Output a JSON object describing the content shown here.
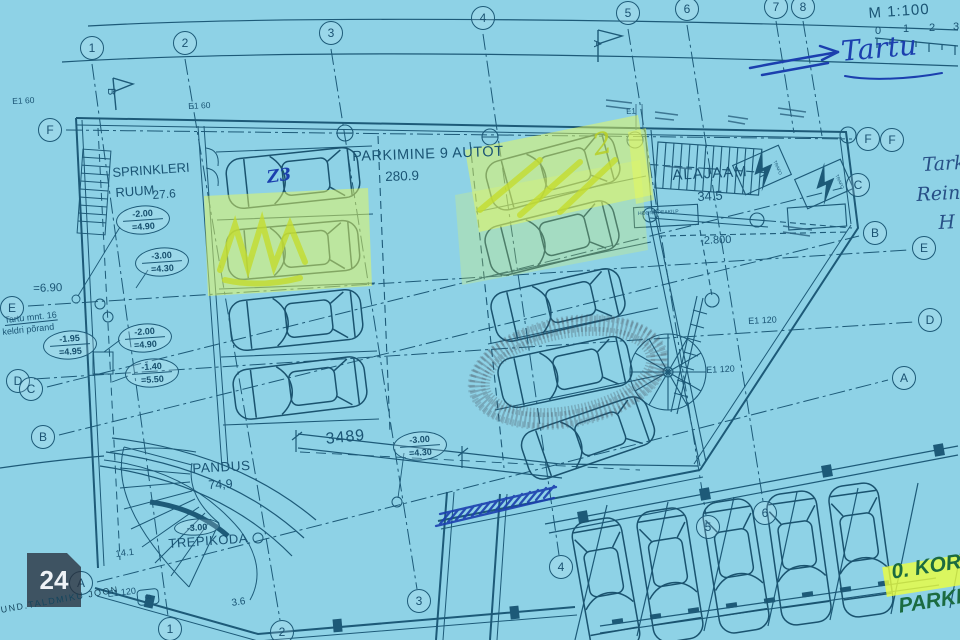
{
  "meta": {
    "scale": "M 1:100",
    "ticks": [
      "0",
      "1",
      "2",
      "3"
    ]
  },
  "pen": {
    "site": "Tartu",
    "margin1": "Tark",
    "margin2": "Reina",
    "margin3": "H",
    "car_mark": "Z3",
    "stall_mark": "2"
  },
  "rooms": {
    "sprinkler": {
      "l1": "SPRINKLERI",
      "l2": "RUUM",
      "area": "27.6"
    },
    "parking": {
      "title": "PARKIMINE 9 AUTOT",
      "area": "280.9"
    },
    "alajaam": {
      "title": "ALAJAAM",
      "area": "34.5",
      "level": "-2.800",
      "board": "HOONE PEAKILP",
      "trafo1": "TRAFO",
      "trafo2": "TRAFO"
    },
    "pandus": {
      "title": "PANDUS",
      "area": "74,9"
    },
    "trepikoda": {
      "title": "TREPIKODA",
      "area": "14.1"
    }
  },
  "tags": [
    {
      "t": "-2.00",
      "b": "=4.90"
    },
    {
      "t": "-3.00",
      "b": "=4.30"
    },
    {
      "t": "-1.95",
      "b": "=4.95"
    },
    {
      "t": "-2.00",
      "b": "=4.90"
    },
    {
      "t": "-1.40",
      "b": "=5.50"
    },
    {
      "t": "-3.00",
      "b": "=4.30"
    },
    {
      "t": "-3.00"
    }
  ],
  "notes": {
    "approx": "=6.90",
    "street1": "Tartu mnt. 16",
    "street2": "keldri põrand",
    "e1a": "E1 60",
    "e1b": "E1 60",
    "e1c": "E1 120",
    "e1d": "E1 120",
    "e1e": "E1 120",
    "e1f": "E1",
    "dim1": "3489",
    "dim2": "3.6"
  },
  "grid": {
    "top": [
      "1",
      "2",
      "3",
      "4",
      "5",
      "6",
      "7",
      "8"
    ],
    "bottom": [
      "1",
      "2",
      "3",
      "4",
      "5",
      "6"
    ],
    "left": [
      "F",
      "E",
      "D",
      "C",
      "B",
      "A"
    ],
    "right": [
      "F",
      "F",
      "C",
      "B",
      "E",
      "D",
      "A"
    ],
    "sections": {
      "a": "A",
      "b": "B"
    },
    "col_mark": "8"
  },
  "footer": {
    "watermark": "24",
    "baseline": "UND.TALDMIKU JOON",
    "floor": "0. KOR",
    "floor2": "PARKL"
  }
}
